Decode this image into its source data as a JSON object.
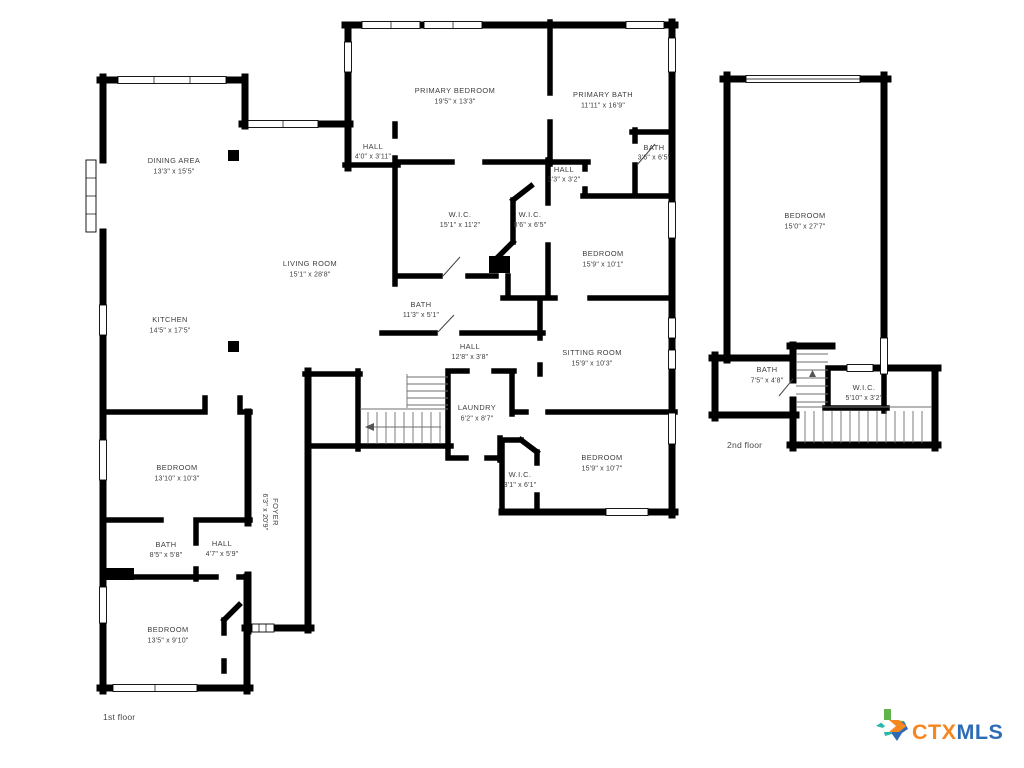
{
  "rooms": {
    "primary_bedroom": {
      "name": "PRIMARY BEDROOM",
      "dims": "19'5\" x 13'3\""
    },
    "primary_bath": {
      "name": "PRIMARY BATH",
      "dims": "11'11\" x 16'9\""
    },
    "hall_primary": {
      "name": "HALL",
      "dims": "4'0\" x 3'11\""
    },
    "hall_small": {
      "name": "HALL",
      "dims": "3'3\" x 3'2\""
    },
    "bath_small": {
      "name": "BATH",
      "dims": "3'6\" x 6'5\""
    },
    "wic_primary": {
      "name": "W.I.C.",
      "dims": "15'1\" x 11'2\""
    },
    "wic_mid": {
      "name": "W.I.C.",
      "dims": "8'6\" x 6'5\""
    },
    "bedroom_ne": {
      "name": "BEDROOM",
      "dims": "15'9\" x 10'1\""
    },
    "bath_center": {
      "name": "BATH",
      "dims": "11'3\" x 5'1\""
    },
    "hall_center": {
      "name": "HALL",
      "dims": "12'8\" x 3'8\""
    },
    "sitting_room": {
      "name": "SITTING ROOM",
      "dims": "15'9\" x 10'3\""
    },
    "laundry": {
      "name": "LAUNDRY",
      "dims": "6'2\" x 8'7\""
    },
    "wic_small": {
      "name": "W.I.C.",
      "dims": "3'1\" x 6'1\""
    },
    "bedroom_se": {
      "name": "BEDROOM",
      "dims": "15'9\" x 10'7\""
    },
    "dining_area": {
      "name": "DINING AREA",
      "dims": "13'3\" x 15'5\""
    },
    "kitchen": {
      "name": "KITCHEN",
      "dims": "14'5\" x 17'5\""
    },
    "living_room": {
      "name": "LIVING ROOM",
      "dims": "15'1\" x 28'8\""
    },
    "foyer": {
      "name": "FOYER",
      "dims": "6'3\" x 20'9\""
    },
    "bedroom_w": {
      "name": "BEDROOM",
      "dims": "13'10\" x 10'3\""
    },
    "bath_w": {
      "name": "BATH",
      "dims": "8'5\" x 5'8\""
    },
    "hall_w": {
      "name": "HALL",
      "dims": "4'7\" x 5'9\""
    },
    "bedroom_sw": {
      "name": "BEDROOM",
      "dims": "13'5\" x 9'10\""
    },
    "bedroom_2f": {
      "name": "BEDROOM",
      "dims": "15'0\" x 27'7\""
    },
    "bath_2f": {
      "name": "BATH",
      "dims": "7'5\" x 4'8\""
    },
    "wic_2f": {
      "name": "W.I.C.",
      "dims": "5'10\" x 3'2\""
    }
  },
  "floor_labels": {
    "first": "1st floor",
    "second": "2nd floor"
  },
  "logo": {
    "prefix": "CTX",
    "suffix": "MLS",
    "prefix_color": "#F6861F",
    "suffix_color": "#2D6CB5",
    "texas_green": "#5FB54B",
    "texas_teal": "#28B7A8",
    "texas_orange": "#F6861F",
    "texas_blue": "#2D6CB5"
  }
}
